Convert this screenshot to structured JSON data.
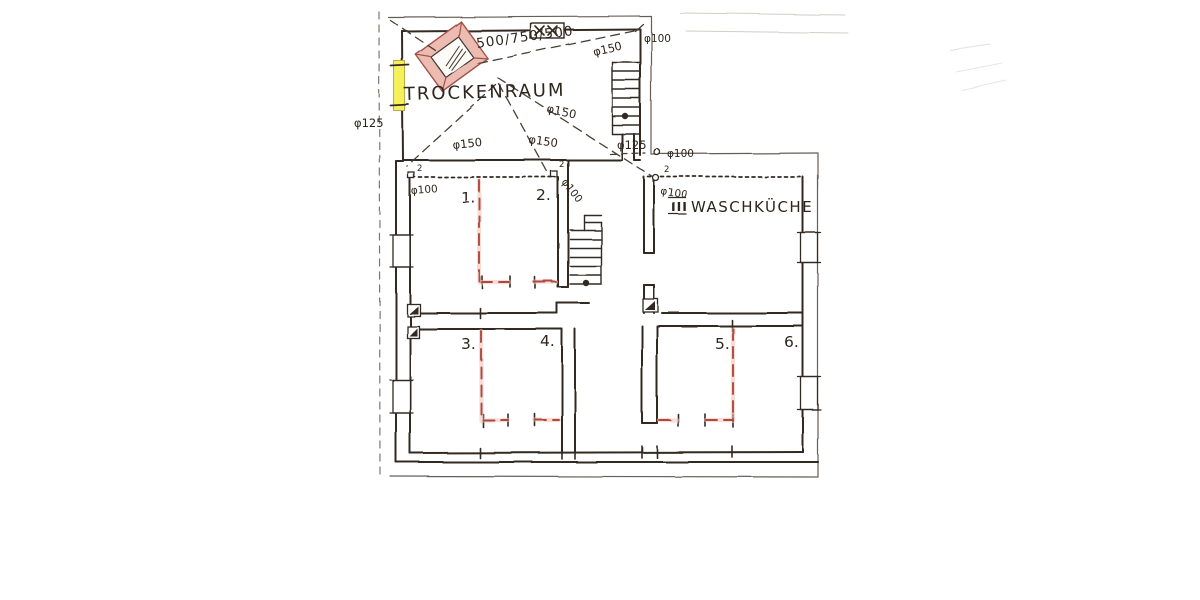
{
  "document": {
    "type": "scanned hand-drawn basement floor plan",
    "background": "#ffffff"
  },
  "plan": {
    "labels": {
      "trockenraum": "TROCKENRAUM",
      "waschkueche": "WASCHKÜCHE",
      "waschkueche_marker": "III"
    },
    "room_numbers": [
      "1.",
      "2.",
      "3.",
      "4.",
      "5.",
      "6."
    ],
    "dimensions": {
      "stove": "500/750/500",
      "duct150": "φ150",
      "duct125": "φ125",
      "duct100": "φ100",
      "corner_mark": "2"
    },
    "symbols": {
      "stove": "drying-stove (pink, rotated, hatched core)",
      "yellow_window": "highlighted window/vent in left wall of Trockenraum",
      "x_window": "top wall window with two X marks",
      "stairs": "two staircases with treads and landing dots",
      "chimneys": "squares with filled diagonal (flues)",
      "red_walls": "red dashed proposed partition walls"
    },
    "colors": {
      "ink": "#3a3128",
      "pencil": "#6b6257",
      "red_wall": "#b0493f",
      "red_tint": "#f0c0b4",
      "stove_fill": "#ecbcb2",
      "stove_edge": "#a35248",
      "yellow": "#f4ef5a",
      "paper": "#ffffff"
    }
  }
}
